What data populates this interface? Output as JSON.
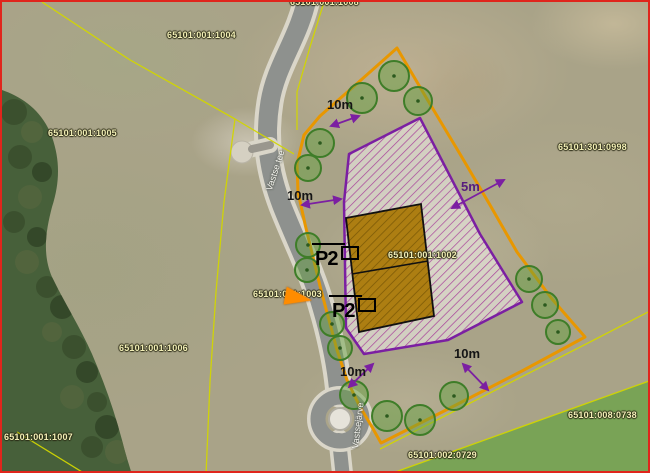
{
  "map": {
    "type": "aerial-cadastral-plan",
    "colors": {
      "frame": "#e0251c",
      "plot_boundary": "#e89700",
      "building_zone": "#7b1fa2",
      "hatch_line": "#a8439a",
      "building_fill": "#ad7e12",
      "building_outline": "#111111",
      "tree_fill": "#5f9f3c",
      "tree_stroke": "#3e7d28",
      "cadastral_line": "#d2d600",
      "cadastral_text": "#f2efb6",
      "road": "#8e918e",
      "dimension": "#7b1fa2",
      "marker": "#ff8c00",
      "forest": "#47603a",
      "green_field": "#79a356"
    },
    "parcel_labels": [
      {
        "text": "65101:001:1008",
        "x": 288,
        "y": -4
      },
      {
        "text": "65101:001:1004",
        "x": 165,
        "y": 29
      },
      {
        "text": "65101:001:1005",
        "x": 46,
        "y": 127
      },
      {
        "text": "65101:301:0998",
        "x": 556,
        "y": 141
      },
      {
        "text": "65101:001:1002",
        "x": 386,
        "y": 249
      },
      {
        "text": "65101:001:1003",
        "x": 251,
        "y": 288
      },
      {
        "text": "65101:001:1006",
        "x": 117,
        "y": 342
      },
      {
        "text": "65101:001:1007",
        "x": 2,
        "y": 431
      },
      {
        "text": "65101:002:0729",
        "x": 406,
        "y": 449
      },
      {
        "text": "65101:008:0738",
        "x": 566,
        "y": 409
      }
    ],
    "road_labels": [
      {
        "text": "Vastse tee",
        "x": 263,
        "y": 187,
        "rot": -72
      },
      {
        "text": "Vastsejärve",
        "x": 349,
        "y": 446,
        "rot": -83
      }
    ],
    "dimension_labels": [
      {
        "text": "10m",
        "x": 325,
        "y": 96,
        "accent": false
      },
      {
        "text": "10m",
        "x": 285,
        "y": 187,
        "accent": false
      },
      {
        "text": "5m",
        "x": 459,
        "y": 178,
        "accent": true
      },
      {
        "text": "10m",
        "x": 338,
        "y": 363,
        "accent": false
      },
      {
        "text": "10m",
        "x": 452,
        "y": 345,
        "accent": false
      }
    ],
    "parking_signs": [
      {
        "text": "P2",
        "x": 313,
        "y": 247
      },
      {
        "text": "P2",
        "x": 330,
        "y": 299
      }
    ],
    "trees": [
      {
        "x": 360,
        "y": 96,
        "r": 15
      },
      {
        "x": 392,
        "y": 74,
        "r": 15
      },
      {
        "x": 416,
        "y": 99,
        "r": 14
      },
      {
        "x": 318,
        "y": 141,
        "r": 14
      },
      {
        "x": 306,
        "y": 166,
        "r": 13
      },
      {
        "x": 306,
        "y": 243,
        "r": 12
      },
      {
        "x": 305,
        "y": 268,
        "r": 12
      },
      {
        "x": 330,
        "y": 322,
        "r": 12
      },
      {
        "x": 338,
        "y": 346,
        "r": 12
      },
      {
        "x": 352,
        "y": 393,
        "r": 14
      },
      {
        "x": 385,
        "y": 414,
        "r": 15
      },
      {
        "x": 418,
        "y": 418,
        "r": 15
      },
      {
        "x": 452,
        "y": 394,
        "r": 14
      },
      {
        "x": 527,
        "y": 277,
        "r": 13
      },
      {
        "x": 543,
        "y": 303,
        "r": 13
      },
      {
        "x": 556,
        "y": 330,
        "r": 12
      }
    ]
  }
}
